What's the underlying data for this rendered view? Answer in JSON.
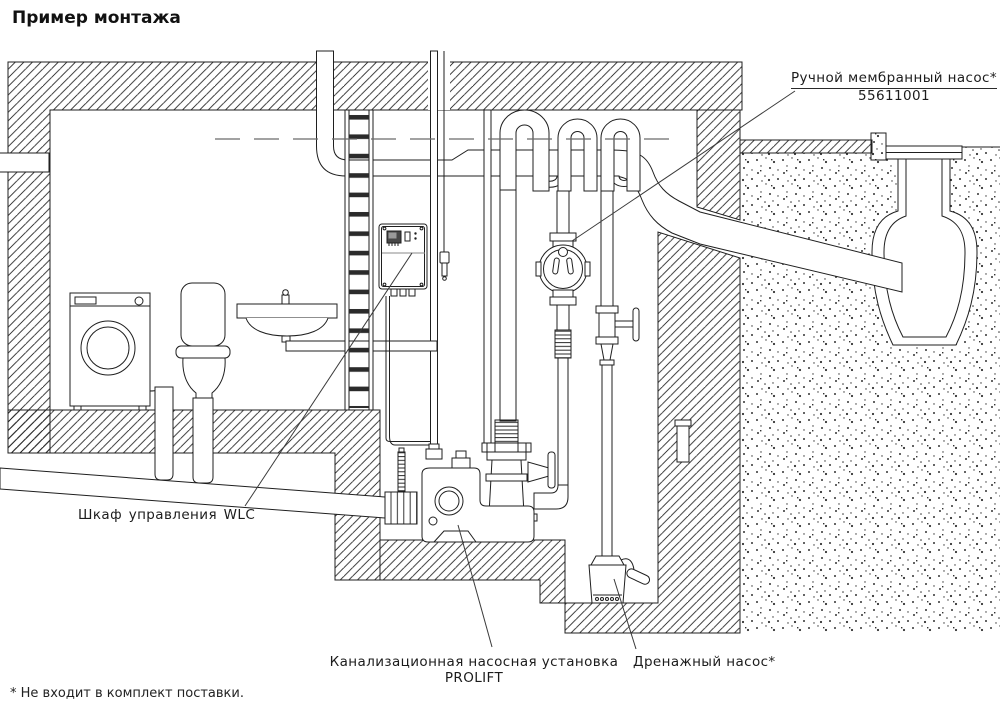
{
  "title": "Пример монтажа",
  "labels": {
    "manual_pump": {
      "line1": "Ручной мембранный насос*",
      "line2": "55611001"
    },
    "control_cabinet": "Шкаф управления WLC",
    "prolift": {
      "line1": "Канализационная насосная установка",
      "line2": "PROLIFT"
    },
    "drainage_pump": "Дренажный насос*"
  },
  "footnote": "* Не входит в комплект поставки.",
  "colors": {
    "background": "#ffffff",
    "line": "#1f1f1f",
    "leader": "#3a3a3a",
    "water_level": "#6a6a6a",
    "cabinet_screen": "#474747",
    "ladder_rung": "#2b2b2b"
  }
}
